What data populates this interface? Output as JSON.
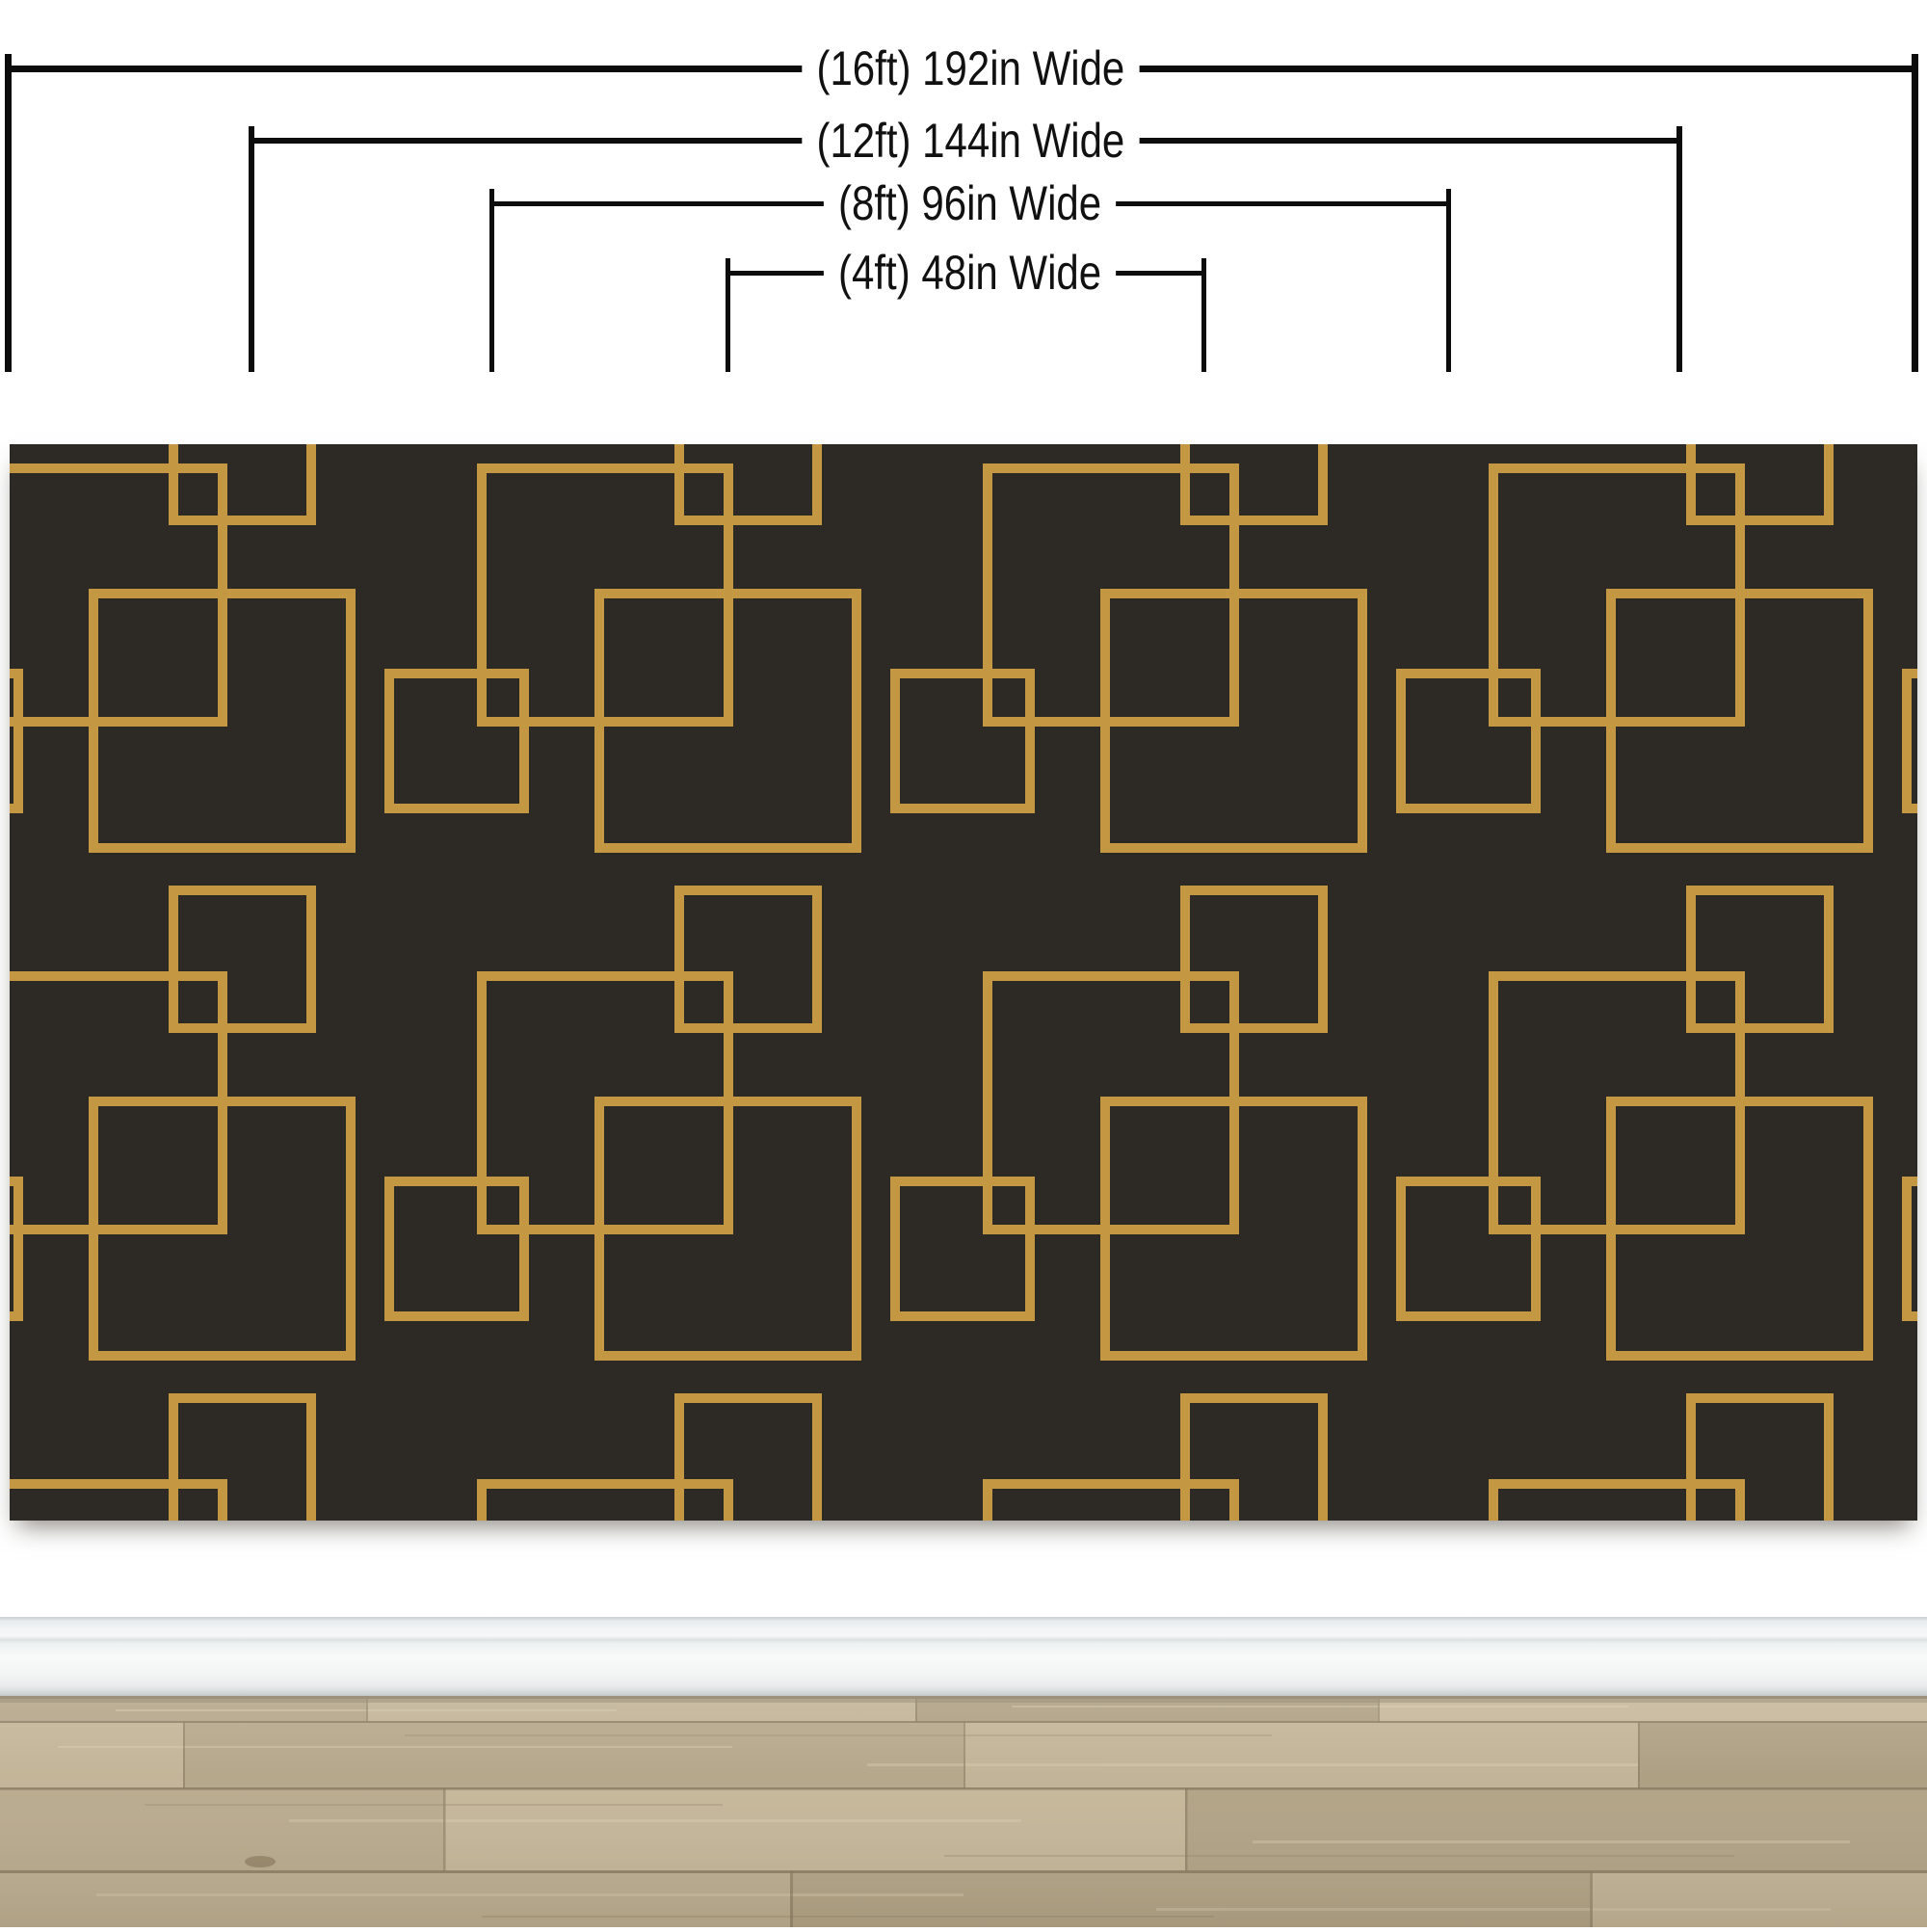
{
  "measurement_guide": {
    "labels": [
      {
        "name": "width-16ft",
        "text": "(16ft) 192in Wide",
        "feet": 16,
        "inches": 192
      },
      {
        "name": "width-12ft",
        "text": "(12ft) 144in Wide",
        "feet": 12,
        "inches": 144
      },
      {
        "name": "width-8ft",
        "text": "(8ft) 96in Wide",
        "feet": 8,
        "inches": 96
      },
      {
        "name": "width-4ft",
        "text": "(4ft) 48in Wide",
        "feet": 4,
        "inches": 48
      }
    ]
  },
  "colors": {
    "bracket_line": "#0c0c0c",
    "label_text": "#111111",
    "panel_background": "#2d2924",
    "pattern_gold": "#c49843",
    "wall_white": "#ffffff",
    "baseboard_face": "#f2f5f5",
    "floor_base": "#b6a789",
    "floor_seam": "#82745a"
  }
}
